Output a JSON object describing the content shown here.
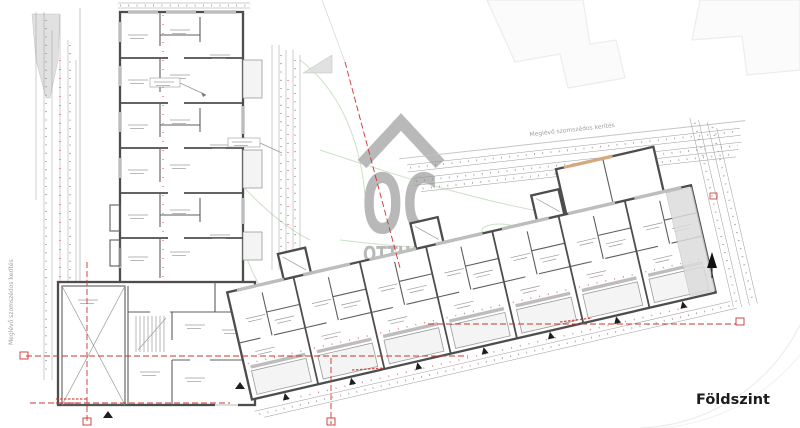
{
  "plan": {
    "floor_label": "Földszint",
    "type": "architectural ground-floor plan",
    "left_wing_units": 5,
    "right_wing_units": 7
  },
  "watermark": {
    "wordmark": "OC",
    "name_line1": "OTTHON",
    "name_line2": "CENTRUM",
    "roof_icon": "roof-chevron",
    "color": "#b3b3b3"
  },
  "annotations": {
    "fence_label_top": "Meglévő szomszédos kerítés",
    "fence_label_left": "Meglévő szomszédos kerítés"
  },
  "colors": {
    "wall": "#4d4d4d",
    "section_red": "#cc3430",
    "landscape_green": "#c2ddba",
    "dimension_gray": "#9a9a9a",
    "shading_gray": "#dcdcdc",
    "existing_structure_tan": "#d9a87a"
  }
}
